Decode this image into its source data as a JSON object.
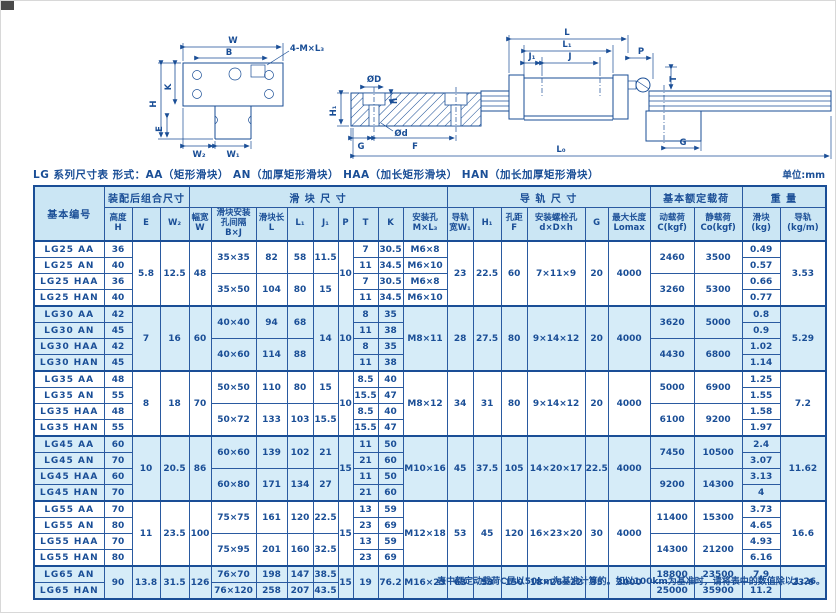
{
  "page": {
    "title": "LG 系列尺寸表  形式：AA（矩形滑块） AN（加厚矩形滑块） HAA（加长矩形滑块） HAN（加长加厚矩形滑块）",
    "unit": "单位:mm",
    "footnote": "表中额定动载荷C是以50km为基准计算的。如以100km为基准时，请将表中的数值除以1.26。"
  },
  "colors": {
    "ink": "#1a4e96",
    "header_bg": "#cbe6f4",
    "shade_bg": "#d6ecf8"
  },
  "diagram": {
    "front": {
      "w": "W",
      "b": "B",
      "screws": "4-M×L₃",
      "h": "H",
      "k": "K",
      "e": "E",
      "w2": "W₂",
      "w1": "W₁"
    },
    "rail": {
      "dD": "ØD",
      "h1": "H₁",
      "depth": "h",
      "dd": "Ød",
      "g": "G",
      "f": "F",
      "l0": "L₀"
    },
    "side": {
      "l": "L",
      "l1": "L₁",
      "j1": "J₁",
      "j": "J",
      "p": "P",
      "t": "T",
      "g": "G"
    }
  },
  "table": {
    "header_groups": {
      "model": "基本编号",
      "assembly": "装配后组合尺寸",
      "block": "滑 块 尺 寸",
      "rail": "导 轨 尺 寸",
      "load": "基本额定载荷",
      "weight": "重 量"
    },
    "columns": [
      "高度\nH",
      "E",
      "W₂",
      "幅宽\nW",
      "滑块安装\n孔间隔\nB×J",
      "滑块长\nL",
      "L₁",
      "J₁",
      "P",
      "T",
      "K",
      "安装孔\nM×L₃",
      "导轨\n宽W₁",
      "H₁",
      "孔距\nF",
      "安装螺栓孔\nd×D×h",
      "G",
      "最大长度\nLomax",
      "动载荷\nC(kgf)",
      "静载荷\nCo(kgf)",
      "滑块\n(kg)",
      "导轨\n(kg/m)"
    ],
    "rows": [
      {
        "g": 1,
        "cells": [
          "LG25 AA",
          "36",
          {
            "t": "5.8",
            "r": 4
          },
          {
            "t": "12.5",
            "r": 4
          },
          {
            "t": "48",
            "r": 4
          },
          {
            "t": "35×35",
            "r": 2
          },
          {
            "t": "82",
            "r": 2
          },
          {
            "t": "58",
            "r": 2
          },
          {
            "t": "11.5",
            "r": 2
          },
          {
            "t": "10",
            "r": 4
          },
          "7",
          "30.5",
          "M6×8",
          {
            "t": "23",
            "r": 4
          },
          {
            "t": "22.5",
            "r": 4
          },
          {
            "t": "60",
            "r": 4
          },
          {
            "t": "7×11×9",
            "r": 4
          },
          {
            "t": "20",
            "r": 4
          },
          {
            "t": "4000",
            "r": 4
          },
          {
            "t": "2460",
            "r": 2
          },
          {
            "t": "3500",
            "r": 2
          },
          "0.49",
          {
            "t": "3.53",
            "r": 4
          }
        ]
      },
      {
        "cells": [
          "LG25 AN",
          "40",
          "11",
          "34.5",
          "M6×10",
          "0.57"
        ]
      },
      {
        "cells": [
          "LG25 HAA",
          "36",
          {
            "t": "35×50",
            "r": 2
          },
          {
            "t": "104",
            "r": 2
          },
          {
            "t": "80",
            "r": 2
          },
          {
            "t": "15",
            "r": 2
          },
          "7",
          "30.5",
          "M6×8",
          {
            "t": "3260",
            "r": 2
          },
          {
            "t": "5300",
            "r": 2
          },
          "0.66"
        ]
      },
      {
        "cells": [
          "LG25 HAN",
          "40",
          "11",
          "34.5",
          "M6×10",
          "0.77"
        ]
      },
      {
        "g": 1,
        "s": 1,
        "cells": [
          "LG30 AA",
          "42",
          {
            "t": "7",
            "r": 4
          },
          {
            "t": "16",
            "r": 4
          },
          {
            "t": "60",
            "r": 4
          },
          {
            "t": "40×40",
            "r": 2
          },
          {
            "t": "94",
            "r": 2
          },
          {
            "t": "68",
            "r": 2
          },
          {
            "t": "14",
            "r": 4
          },
          {
            "t": "10",
            "r": 4
          },
          "8",
          "35",
          {
            "t": "M8×11",
            "r": 4
          },
          {
            "t": "28",
            "r": 4
          },
          {
            "t": "27.5",
            "r": 4
          },
          {
            "t": "80",
            "r": 4
          },
          {
            "t": "9×14×12",
            "r": 4
          },
          {
            "t": "20",
            "r": 4
          },
          {
            "t": "4000",
            "r": 4
          },
          {
            "t": "3620",
            "r": 2
          },
          {
            "t": "5000",
            "r": 2
          },
          "0.8",
          {
            "t": "5.29",
            "r": 4
          }
        ]
      },
      {
        "s": 1,
        "cells": [
          "LG30 AN",
          "45",
          "11",
          "38",
          "0.9"
        ]
      },
      {
        "s": 1,
        "cells": [
          "LG30 HAA",
          "42",
          {
            "t": "40×60",
            "r": 2
          },
          {
            "t": "114",
            "r": 2
          },
          {
            "t": "88",
            "r": 2
          },
          "8",
          "35",
          {
            "t": "4430",
            "r": 2
          },
          {
            "t": "6800",
            "r": 2
          },
          "1.02"
        ]
      },
      {
        "s": 1,
        "cells": [
          "LG30 HAN",
          "45",
          "11",
          "38",
          "1.14"
        ]
      },
      {
        "g": 1,
        "cells": [
          "LG35 AA",
          "48",
          {
            "t": "8",
            "r": 4
          },
          {
            "t": "18",
            "r": 4
          },
          {
            "t": "70",
            "r": 4
          },
          {
            "t": "50×50",
            "r": 2
          },
          {
            "t": "110",
            "r": 2
          },
          {
            "t": "80",
            "r": 2
          },
          {
            "t": "15",
            "r": 2
          },
          {
            "t": "10",
            "r": 4
          },
          "8.5",
          "40",
          {
            "t": "M8×12",
            "r": 4
          },
          {
            "t": "34",
            "r": 4
          },
          {
            "t": "31",
            "r": 4
          },
          {
            "t": "80",
            "r": 4
          },
          {
            "t": "9×14×12",
            "r": 4
          },
          {
            "t": "20",
            "r": 4
          },
          {
            "t": "4000",
            "r": 4
          },
          {
            "t": "5000",
            "r": 2
          },
          {
            "t": "6900",
            "r": 2
          },
          "1.25",
          {
            "t": "7.2",
            "r": 4
          }
        ]
      },
      {
        "cells": [
          "LG35 AN",
          "55",
          "15.5",
          "47",
          "1.55"
        ]
      },
      {
        "cells": [
          "LG35 HAA",
          "48",
          {
            "t": "50×72",
            "r": 2
          },
          {
            "t": "133",
            "r": 2
          },
          {
            "t": "103",
            "r": 2
          },
          {
            "t": "15.5",
            "r": 2
          },
          "8.5",
          "40",
          {
            "t": "6100",
            "r": 2
          },
          {
            "t": "9200",
            "r": 2
          },
          "1.58"
        ]
      },
      {
        "cells": [
          "LG35 HAN",
          "55",
          "15.5",
          "47",
          "1.97"
        ]
      },
      {
        "g": 1,
        "s": 1,
        "cells": [
          "LG45 AA",
          "60",
          {
            "t": "10",
            "r": 4
          },
          {
            "t": "20.5",
            "r": 4
          },
          {
            "t": "86",
            "r": 4
          },
          {
            "t": "60×60",
            "r": 2
          },
          {
            "t": "139",
            "r": 2
          },
          {
            "t": "102",
            "r": 2
          },
          {
            "t": "21",
            "r": 2
          },
          {
            "t": "15",
            "r": 4
          },
          "11",
          "50",
          {
            "t": "M10×16",
            "r": 4
          },
          {
            "t": "45",
            "r": 4
          },
          {
            "t": "37.5",
            "r": 4
          },
          {
            "t": "105",
            "r": 4
          },
          {
            "t": "14×20×17",
            "r": 4
          },
          {
            "t": "22.5",
            "r": 4
          },
          {
            "t": "4000",
            "r": 4
          },
          {
            "t": "7450",
            "r": 2
          },
          {
            "t": "10500",
            "r": 2
          },
          "2.4",
          {
            "t": "11.62",
            "r": 4
          }
        ]
      },
      {
        "s": 1,
        "cells": [
          "LG45 AN",
          "70",
          "21",
          "60",
          "3.07"
        ]
      },
      {
        "s": 1,
        "cells": [
          "LG45 HAA",
          "60",
          {
            "t": "60×80",
            "r": 2
          },
          {
            "t": "171",
            "r": 2
          },
          {
            "t": "134",
            "r": 2
          },
          {
            "t": "27",
            "r": 2
          },
          "11",
          "50",
          {
            "t": "9200",
            "r": 2
          },
          {
            "t": "14300",
            "r": 2
          },
          "3.13"
        ]
      },
      {
        "s": 1,
        "cells": [
          "LG45 HAN",
          "70",
          "21",
          "60",
          "4"
        ]
      },
      {
        "g": 1,
        "cells": [
          "LG55 AA",
          "70",
          {
            "t": "11",
            "r": 4
          },
          {
            "t": "23.5",
            "r": 4
          },
          {
            "t": "100",
            "r": 4
          },
          {
            "t": "75×75",
            "r": 2
          },
          {
            "t": "161",
            "r": 2
          },
          {
            "t": "120",
            "r": 2
          },
          {
            "t": "22.5",
            "r": 2
          },
          {
            "t": "15",
            "r": 4
          },
          "13",
          "59",
          {
            "t": "M12×18",
            "r": 4
          },
          {
            "t": "53",
            "r": 4
          },
          {
            "t": "45",
            "r": 4
          },
          {
            "t": "120",
            "r": 4
          },
          {
            "t": "16×23×20",
            "r": 4
          },
          {
            "t": "30",
            "r": 4
          },
          {
            "t": "4000",
            "r": 4
          },
          {
            "t": "11400",
            "r": 2
          },
          {
            "t": "15300",
            "r": 2
          },
          "3.73",
          {
            "t": "16.6",
            "r": 4
          }
        ]
      },
      {
        "cells": [
          "LG55 AN",
          "80",
          "23",
          "69",
          "4.65"
        ]
      },
      {
        "cells": [
          "LG55 HAA",
          "70",
          {
            "t": "75×95",
            "r": 2
          },
          {
            "t": "201",
            "r": 2
          },
          {
            "t": "160",
            "r": 2
          },
          {
            "t": "32.5",
            "r": 2
          },
          "13",
          "59",
          {
            "t": "14300",
            "r": 2
          },
          {
            "t": "21200",
            "r": 2
          },
          "4.93"
        ]
      },
      {
        "cells": [
          "LG55 HAN",
          "80",
          "23",
          "69",
          "6.16"
        ]
      },
      {
        "g": 1,
        "s": 1,
        "cells": [
          "LG65 AN",
          {
            "t": "90",
            "r": 2
          },
          {
            "t": "13.8",
            "r": 2
          },
          {
            "t": "31.5",
            "r": 2
          },
          {
            "t": "126",
            "r": 2
          },
          "76×70",
          "198",
          "147",
          "38.5",
          {
            "t": "15",
            "r": 2
          },
          {
            "t": "19",
            "r": 2
          },
          {
            "t": "76.2",
            "r": 2
          },
          {
            "t": "M16×23",
            "r": 2
          },
          {
            "t": "63",
            "r": 2
          },
          {
            "t": "53",
            "r": 2
          },
          {
            "t": "150",
            "r": 2
          },
          {
            "t": "18×26×22",
            "r": 2
          },
          {
            "t": "35",
            "r": 2
          },
          {
            "t": "3000",
            "r": 2
          },
          "18800",
          "23500",
          "7.9",
          {
            "t": "23.6",
            "r": 2
          }
        ]
      },
      {
        "s": 1,
        "cells": [
          "LG65 HAN",
          "76×120",
          "258",
          "207",
          "43.5",
          "25000",
          "35900",
          "11.2"
        ]
      }
    ]
  }
}
